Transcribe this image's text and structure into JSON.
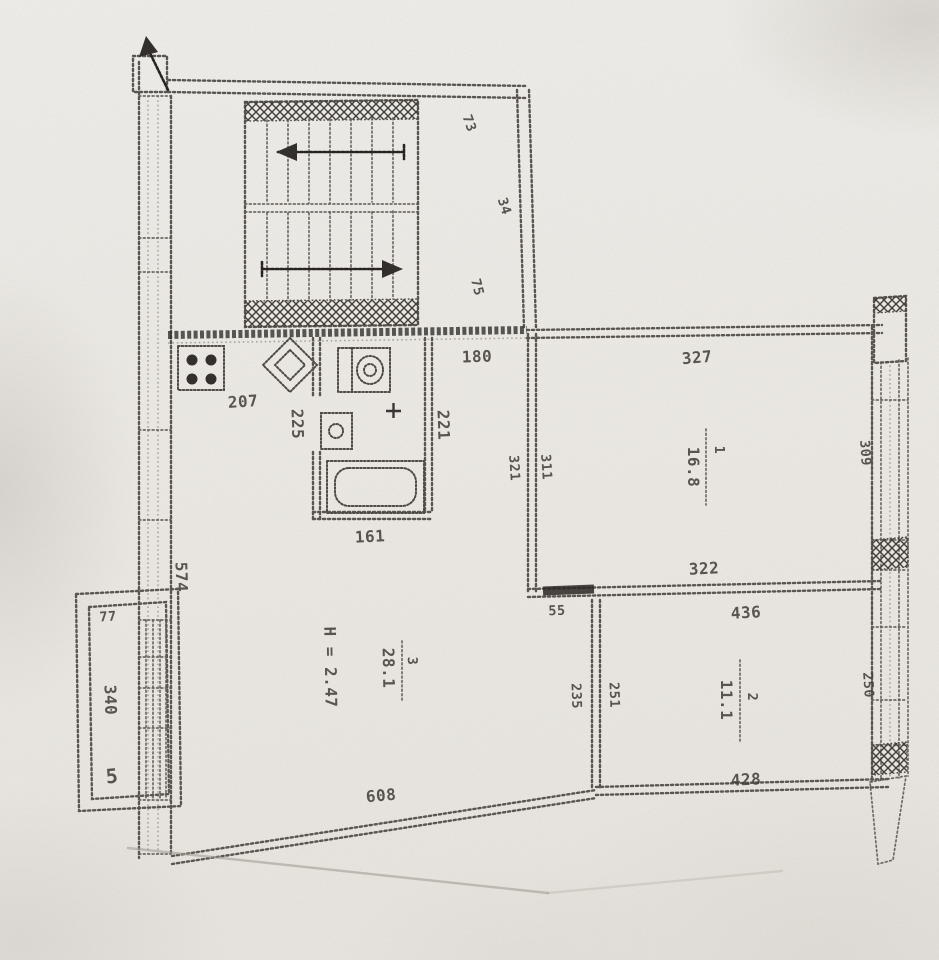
{
  "plan": {
    "stairs": {
      "dim_upper": "73",
      "dim_mid": "34",
      "dim_lower": "75"
    },
    "kitchen": {
      "dim_width": "207",
      "dim_sink": "225"
    },
    "bathroom": {
      "dim_right": "221",
      "dim_bottom": "161"
    },
    "hallway": {
      "dim_width": "180"
    },
    "room1": {
      "number": "1",
      "area": "16.8",
      "dim_top": "327",
      "dim_bottom": "322",
      "dim_wall_outer": "321",
      "dim_wall_inner": "311"
    },
    "room2": {
      "number": "2",
      "area": "11.1",
      "dim_top": "436",
      "dim_bottom": "428",
      "dim_wall_outer": "235",
      "dim_wall_inner": "251",
      "dim_corner": "55"
    },
    "room3": {
      "number": "3",
      "area": "28.1",
      "ceiling_height": "H = 2.47",
      "dim_bottom": "608",
      "dim_left": "574"
    },
    "balcony": {
      "dim_width": "77",
      "dim_length": "340",
      "mark": "5"
    },
    "facade": {
      "dim_upper": "309",
      "dim_lower": "250"
    }
  },
  "colors": {
    "paper": "#efede9",
    "ink": "#403d39",
    "wall": "#57534e",
    "dark": "#2d2a27"
  }
}
